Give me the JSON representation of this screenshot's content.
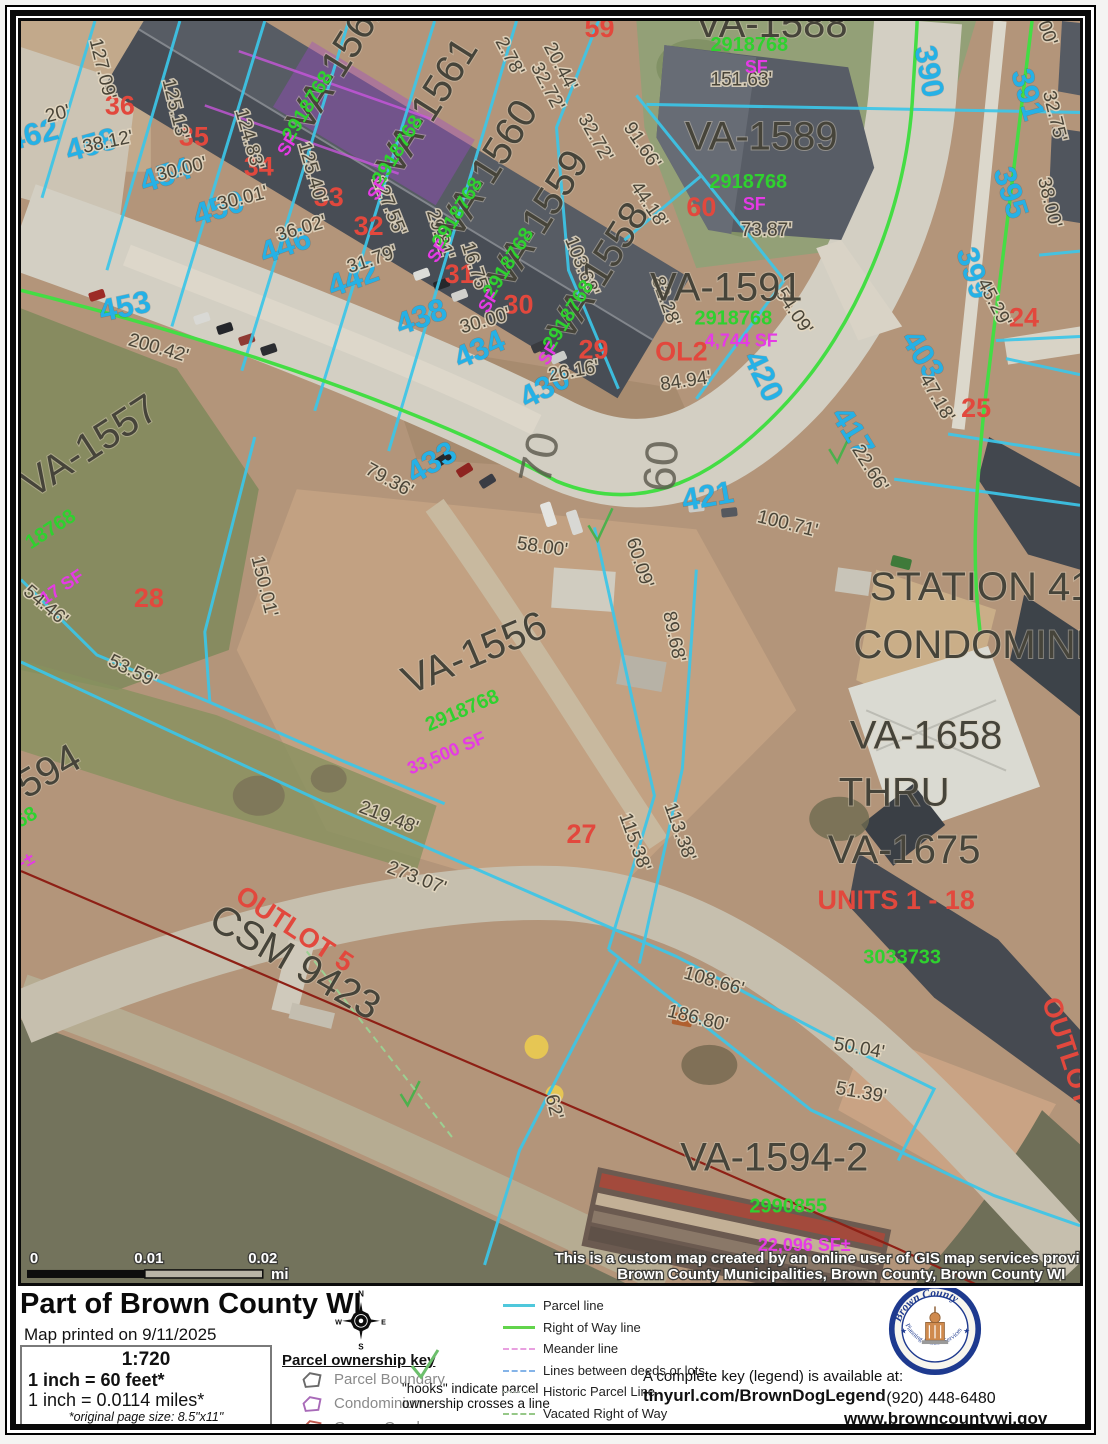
{
  "map": {
    "labels": [
      {
        "t": "462",
        "x": 38,
        "y": 137,
        "r": -14,
        "c": "addr"
      },
      {
        "t": "458",
        "x": 97,
        "y": 147,
        "r": -16,
        "c": "addr"
      },
      {
        "t": "454",
        "x": 172,
        "y": 177,
        "r": -18,
        "c": "addr"
      },
      {
        "t": "450",
        "x": 225,
        "y": 210,
        "r": -18,
        "c": "addr"
      },
      {
        "t": "446",
        "x": 292,
        "y": 247,
        "r": -20,
        "c": "addr"
      },
      {
        "t": "442",
        "x": 360,
        "y": 280,
        "r": -20,
        "c": "addr"
      },
      {
        "t": "438",
        "x": 428,
        "y": 318,
        "r": -20,
        "c": "addr"
      },
      {
        "t": "434",
        "x": 487,
        "y": 350,
        "r": -24,
        "c": "addr"
      },
      {
        "t": "430",
        "x": 553,
        "y": 388,
        "r": -28,
        "c": "addr"
      },
      {
        "t": "453",
        "x": 130,
        "y": 308,
        "r": -12,
        "c": "addr"
      },
      {
        "t": "433",
        "x": 440,
        "y": 462,
        "r": -30,
        "c": "addr"
      },
      {
        "t": "421",
        "x": 713,
        "y": 497,
        "r": -10,
        "c": "addr"
      },
      {
        "t": "420",
        "x": 758,
        "y": 372,
        "r": 64,
        "c": "addr"
      },
      {
        "t": "417",
        "x": 848,
        "y": 428,
        "r": 58,
        "c": "addr"
      },
      {
        "t": "403",
        "x": 918,
        "y": 352,
        "r": 58,
        "c": "addr"
      },
      {
        "t": "399",
        "x": 968,
        "y": 268,
        "r": 72,
        "c": "addr"
      },
      {
        "t": "395",
        "x": 1005,
        "y": 188,
        "r": 72,
        "c": "addr"
      },
      {
        "t": "391",
        "x": 1022,
        "y": 90,
        "r": 74,
        "c": "addr"
      },
      {
        "t": "390",
        "x": 923,
        "y": 66,
        "r": 80,
        "c": "addr"
      },
      {
        "t": "36",
        "x": 123,
        "y": 107,
        "r": 0,
        "c": "lot"
      },
      {
        "t": "35",
        "x": 197,
        "y": 138,
        "r": 0,
        "c": "lot"
      },
      {
        "t": "34",
        "x": 262,
        "y": 168,
        "r": 0,
        "c": "lot"
      },
      {
        "t": "33",
        "x": 332,
        "y": 198,
        "r": 0,
        "c": "lot"
      },
      {
        "t": "32",
        "x": 372,
        "y": 227,
        "r": 0,
        "c": "lot"
      },
      {
        "t": "31",
        "x": 463,
        "y": 275,
        "r": 0,
        "c": "lot"
      },
      {
        "t": "30",
        "x": 522,
        "y": 305,
        "r": 0,
        "c": "lot"
      },
      {
        "t": "29",
        "x": 597,
        "y": 350,
        "r": 0,
        "c": "lot"
      },
      {
        "t": "28",
        "x": 152,
        "y": 597,
        "r": 0,
        "c": "lot",
        "s": 30
      },
      {
        "t": "27",
        "x": 585,
        "y": 832,
        "r": 0,
        "c": "lot",
        "s": 30
      },
      {
        "t": "59",
        "x": 603,
        "y": 30,
        "r": 0,
        "c": "lot"
      },
      {
        "t": "60",
        "x": 705,
        "y": 208,
        "r": 0,
        "c": "lot"
      },
      {
        "t": "24",
        "x": 1028,
        "y": 318,
        "r": 0,
        "c": "lot",
        "s": 30
      },
      {
        "t": "25",
        "x": 980,
        "y": 408,
        "r": 0,
        "c": "lot",
        "s": 30
      },
      {
        "t": "23",
        "x": 1098,
        "y": 222,
        "r": 0,
        "c": "lot"
      },
      {
        "t": "OL2",
        "x": 685,
        "y": 352,
        "r": 0,
        "c": "lot",
        "s": 30
      },
      {
        "t": "UNITS 1 - 18",
        "x": 900,
        "y": 898,
        "r": 0,
        "c": "lot",
        "s": 28
      },
      {
        "t": "OUTLOT 5",
        "x": 293,
        "y": 925,
        "r": 33,
        "c": "lot",
        "s": 32
      },
      {
        "t": "OUTLOT",
        "x": 1063,
        "y": 1042,
        "r": 72,
        "c": "lot",
        "s": 26
      },
      {
        "t": "20'",
        "x": 62,
        "y": 112,
        "r": -14,
        "c": "dim"
      },
      {
        "t": "127.09'",
        "x": 100,
        "y": 63,
        "r": 76,
        "c": "dim"
      },
      {
        "t": "38.12'",
        "x": 112,
        "y": 140,
        "r": -12,
        "c": "dim"
      },
      {
        "t": "125.13'",
        "x": 173,
        "y": 103,
        "r": 76,
        "c": "dim"
      },
      {
        "t": "30.00'",
        "x": 186,
        "y": 167,
        "r": -14,
        "c": "dim"
      },
      {
        "t": "124.83'",
        "x": 247,
        "y": 133,
        "r": 74,
        "c": "dim"
      },
      {
        "t": "30.01'",
        "x": 247,
        "y": 196,
        "r": -14,
        "c": "dim"
      },
      {
        "t": "125.40'",
        "x": 310,
        "y": 166,
        "r": 74,
        "c": "dim"
      },
      {
        "t": "36.02'",
        "x": 306,
        "y": 226,
        "r": -16,
        "c": "dim"
      },
      {
        "t": "127.55'",
        "x": 387,
        "y": 200,
        "r": 68,
        "c": "dim"
      },
      {
        "t": "31.79'",
        "x": 377,
        "y": 257,
        "r": -18,
        "c": "dim"
      },
      {
        "t": "29.81'",
        "x": 438,
        "y": 228,
        "r": 72,
        "c": "dim"
      },
      {
        "t": "16.75'",
        "x": 473,
        "y": 261,
        "r": 72,
        "c": "dim"
      },
      {
        "t": "30.00'",
        "x": 490,
        "y": 318,
        "r": -16,
        "c": "dim"
      },
      {
        "t": "103.68'",
        "x": 580,
        "y": 260,
        "r": 68,
        "c": "dim"
      },
      {
        "t": "26.16'",
        "x": 578,
        "y": 368,
        "r": -10,
        "c": "dim"
      },
      {
        "t": "2.78'",
        "x": 508,
        "y": 52,
        "r": 62,
        "c": "dim"
      },
      {
        "t": "20.44'",
        "x": 559,
        "y": 62,
        "r": 62,
        "c": "dim"
      },
      {
        "t": "32.72'",
        "x": 546,
        "y": 82,
        "r": 62,
        "c": "dim"
      },
      {
        "t": "32.72'",
        "x": 594,
        "y": 133,
        "r": 60,
        "c": "dim"
      },
      {
        "t": "91.66'",
        "x": 641,
        "y": 141,
        "r": 56,
        "c": "dim"
      },
      {
        "t": "44.18'",
        "x": 648,
        "y": 200,
        "r": 56,
        "c": "dim"
      },
      {
        "t": "151.63'",
        "x": 745,
        "y": 78,
        "r": 0,
        "c": "dim"
      },
      {
        "t": "73.87'",
        "x": 770,
        "y": 228,
        "r": 0,
        "c": "dim"
      },
      {
        "t": "82.28'",
        "x": 664,
        "y": 295,
        "r": 70,
        "c": "dim"
      },
      {
        "t": "84.94'",
        "x": 690,
        "y": 378,
        "r": -8,
        "c": "dim"
      },
      {
        "t": "54.09'",
        "x": 793,
        "y": 306,
        "r": 56,
        "c": "dim"
      },
      {
        "t": "22.66'",
        "x": 869,
        "y": 462,
        "r": 58,
        "c": "dim"
      },
      {
        "t": "100.71'",
        "x": 790,
        "y": 520,
        "r": 14,
        "c": "dim"
      },
      {
        "t": "47.18'",
        "x": 936,
        "y": 392,
        "r": 60,
        "c": "dim"
      },
      {
        "t": "45.29'",
        "x": 993,
        "y": 297,
        "r": 62,
        "c": "dim"
      },
      {
        "t": "38.00'",
        "x": 1048,
        "y": 196,
        "r": 76,
        "c": "dim"
      },
      {
        "t": "32.75'",
        "x": 1053,
        "y": 110,
        "r": 76,
        "c": "dim"
      },
      {
        "t": "00'",
        "x": 1046,
        "y": 28,
        "r": 70,
        "c": "dim"
      },
      {
        "t": "200.42'",
        "x": 160,
        "y": 345,
        "r": 16,
        "c": "dim"
      },
      {
        "t": "79.36'",
        "x": 390,
        "y": 476,
        "r": 28,
        "c": "dim"
      },
      {
        "t": "58.00'",
        "x": 545,
        "y": 543,
        "r": 8,
        "c": "dim"
      },
      {
        "t": "60.09'",
        "x": 638,
        "y": 555,
        "r": 72,
        "c": "dim"
      },
      {
        "t": "89.68'",
        "x": 672,
        "y": 628,
        "r": 78,
        "c": "dim"
      },
      {
        "t": "150.01'",
        "x": 262,
        "y": 578,
        "r": 76,
        "c": "dim"
      },
      {
        "t": "54.46'",
        "x": 45,
        "y": 600,
        "r": 40,
        "c": "dim"
      },
      {
        "t": "53.59'",
        "x": 133,
        "y": 666,
        "r": 26,
        "c": "dim"
      },
      {
        "t": "219.48'",
        "x": 390,
        "y": 812,
        "r": 21,
        "c": "dim"
      },
      {
        "t": "273.07'",
        "x": 418,
        "y": 872,
        "r": 21,
        "c": "dim"
      },
      {
        "t": "115.38'",
        "x": 633,
        "y": 833,
        "r": 70,
        "c": "dim"
      },
      {
        "t": "113.38'",
        "x": 678,
        "y": 823,
        "r": 70,
        "c": "dim"
      },
      {
        "t": "108.66'",
        "x": 716,
        "y": 975,
        "r": 16,
        "c": "dim"
      },
      {
        "t": "186.80'",
        "x": 700,
        "y": 1012,
        "r": 14,
        "c": "dim"
      },
      {
        "t": "50.04'",
        "x": 862,
        "y": 1042,
        "r": 10,
        "c": "dim"
      },
      {
        "t": "51.39'",
        "x": 864,
        "y": 1086,
        "r": 10,
        "c": "dim"
      },
      {
        "t": "62'",
        "x": 552,
        "y": 1096,
        "r": 76,
        "c": "dim"
      },
      {
        "t": "VA-1562",
        "x": 352,
        "y": 62,
        "r": -58,
        "c": "parcel",
        "s": 40
      },
      {
        "t": "VA-1561",
        "x": 442,
        "y": 106,
        "r": -58,
        "c": "parcel",
        "s": 40
      },
      {
        "t": "VA-1560",
        "x": 502,
        "y": 168,
        "r": -58,
        "c": "parcel",
        "s": 40
      },
      {
        "t": "VA-1559",
        "x": 553,
        "y": 218,
        "r": -58,
        "c": "parcel",
        "s": 40
      },
      {
        "t": "VA-1558",
        "x": 613,
        "y": 270,
        "r": -58,
        "c": "parcel",
        "s": 40
      },
      {
        "t": "VA-1588",
        "x": 775,
        "y": 30,
        "r": 0,
        "c": "parcel",
        "s": 38
      },
      {
        "t": "VA-1589",
        "x": 765,
        "y": 142,
        "r": 0,
        "c": "parcel",
        "s": 40
      },
      {
        "t": "VA-1591",
        "x": 730,
        "y": 292,
        "r": 0,
        "c": "parcel",
        "s": 24
      },
      {
        "t": "VA-1557",
        "x": 100,
        "y": 448,
        "r": -33,
        "c": "parcel",
        "s": 46
      },
      {
        "t": "VA-1556",
        "x": 483,
        "y": 655,
        "r": -23,
        "c": "parcel",
        "s": 54
      },
      {
        "t": "594",
        "x": 58,
        "y": 772,
        "r": -30,
        "c": "parcel",
        "s": 42
      },
      {
        "t": "VA-1594-2",
        "x": 778,
        "y": 1158,
        "r": 0,
        "c": "parcel",
        "s": 46
      },
      {
        "t": "STATION 41",
        "x": 985,
        "y": 590,
        "r": 0,
        "c": "parcel",
        "s": 40
      },
      {
        "t": "CONDOMINIUM",
        "x": 1005,
        "y": 648,
        "r": 0,
        "c": "parcel",
        "s": 40
      },
      {
        "t": "VA-1658",
        "x": 930,
        "y": 738,
        "r": 0,
        "c": "parcel",
        "s": 44
      },
      {
        "t": "THRU",
        "x": 898,
        "y": 795,
        "r": 0,
        "c": "parcel",
        "s": 44
      },
      {
        "t": "VA-1675",
        "x": 908,
        "y": 852,
        "r": 0,
        "c": "parcel",
        "s": 44
      },
      {
        "t": "CSM 9423",
        "x": 292,
        "y": 962,
        "r": 30,
        "c": "parcel",
        "s": 34
      },
      {
        "t": "CSM",
        "x": 1096,
        "y": 1098,
        "r": 70,
        "c": "parcel",
        "s": 26
      },
      {
        "t": "70",
        "x": 558,
        "y": 452,
        "r": -78,
        "c": "road"
      },
      {
        "t": "60",
        "x": 680,
        "y": 458,
        "r": -86,
        "c": "road"
      },
      {
        "t": "2918768",
        "x": 316,
        "y": 102,
        "r": -58,
        "c": "doc",
        "s": 19
      },
      {
        "t": "2918768",
        "x": 406,
        "y": 146,
        "r": -58,
        "c": "doc",
        "s": 19
      },
      {
        "t": "2918768",
        "x": 466,
        "y": 208,
        "r": -58,
        "c": "doc",
        "s": 19
      },
      {
        "t": "2918768",
        "x": 517,
        "y": 258,
        "r": -58,
        "c": "doc",
        "s": 19
      },
      {
        "t": "2918768",
        "x": 577,
        "y": 310,
        "r": -58,
        "c": "doc",
        "s": 19
      },
      {
        "t": "2918768",
        "x": 753,
        "y": 44,
        "r": 0,
        "c": "doc",
        "s": 20
      },
      {
        "t": "2918768",
        "x": 752,
        "y": 180,
        "r": 0,
        "c": "doc",
        "s": 20
      },
      {
        "t": "2918768",
        "x": 737,
        "y": 316,
        "r": 0,
        "c": "doc",
        "s": 16
      },
      {
        "t": "18768",
        "x": 57,
        "y": 525,
        "r": -33,
        "c": "doc",
        "s": 26
      },
      {
        "t": "2918768",
        "x": 468,
        "y": 706,
        "r": -23,
        "c": "doc",
        "s": 30
      },
      {
        "t": "68",
        "x": 32,
        "y": 812,
        "r": -30,
        "c": "doc",
        "s": 26
      },
      {
        "t": "2990855",
        "x": 792,
        "y": 1200,
        "r": 0,
        "c": "doc",
        "s": 30
      },
      {
        "t": "3033733",
        "x": 906,
        "y": 952,
        "r": 0,
        "c": "doc",
        "s": 26
      },
      {
        "t": "SF",
        "x": 296,
        "y": 140,
        "r": -58,
        "c": "sf",
        "s": 15
      },
      {
        "t": "SF",
        "x": 386,
        "y": 184,
        "r": -58,
        "c": "sf",
        "s": 15
      },
      {
        "t": "SF",
        "x": 446,
        "y": 246,
        "r": -58,
        "c": "sf",
        "s": 15
      },
      {
        "t": "SF",
        "x": 497,
        "y": 296,
        "r": -58,
        "c": "sf",
        "s": 15
      },
      {
        "t": "SF",
        "x": 557,
        "y": 348,
        "r": -58,
        "c": "sf",
        "s": 15
      },
      {
        "t": "SF",
        "x": 760,
        "y": 66,
        "r": 0,
        "c": "sf",
        "s": 17
      },
      {
        "t": "SF",
        "x": 758,
        "y": 202,
        "r": 0,
        "c": "sf",
        "s": 17
      },
      {
        "t": "4,744 SF",
        "x": 745,
        "y": 338,
        "r": 0,
        "c": "sf",
        "s": 16
      },
      {
        "t": "17 SF",
        "x": 68,
        "y": 582,
        "r": -33,
        "c": "sf",
        "s": 30
      },
      {
        "t": "33,500 SF",
        "x": 452,
        "y": 748,
        "r": -23,
        "c": "sf",
        "s": 32
      },
      {
        "t": "F±",
        "x": 30,
        "y": 856,
        "r": -30,
        "c": "sf",
        "s": 28
      },
      {
        "t": "22,096 SF±",
        "x": 808,
        "y": 1238,
        "r": 0,
        "c": "sf",
        "s": 32
      },
      {
        "t": "0",
        "x": 37,
        "y": 1250,
        "r": 0,
        "c": "white",
        "s": 15
      },
      {
        "t": "0.01",
        "x": 152,
        "y": 1250,
        "r": 0,
        "c": "white",
        "s": 15
      },
      {
        "t": "0.02",
        "x": 266,
        "y": 1250,
        "r": 0,
        "c": "white",
        "s": 15
      },
      {
        "t": "mi",
        "x": 283,
        "y": 1266,
        "r": 0,
        "c": "white",
        "s": 14
      },
      {
        "t": "This is a custom map created by an online user of GIS map services provided by",
        "x": 845,
        "y": 1250,
        "r": 0,
        "c": "white",
        "s": 14.5
      },
      {
        "t": "Brown County Municipalities, Brown County, Brown County WI",
        "x": 845,
        "y": 1266,
        "r": 0,
        "c": "white",
        "s": 14.5
      }
    ]
  },
  "footer": {
    "title": "Part of Brown County WI",
    "printed": "Map printed on 9/11/2025",
    "scale_box": {
      "ratio": "1:720",
      "feet": "1 inch = 60 feet*",
      "miles": "1 inch = 0.0114 miles*",
      "note1": "*original page size: 8.5\"x11\"",
      "note2": "Appropriate format depends on zoom level"
    },
    "compass": {
      "n": "N",
      "e": "E",
      "s": "S",
      "w": "W"
    },
    "ownership_key": {
      "title": "Parcel ownership key",
      "items": [
        {
          "label": "Parcel Boundary",
          "color": "#6a6a6a"
        },
        {
          "label": "Condominium",
          "color": "#a86ab8"
        },
        {
          "label": "Gap or Overlap",
          "color": "#c05a50"
        }
      ],
      "hooks_note": "\"hooks\" indicate parcel ownership crosses a line"
    },
    "legend": {
      "items": [
        {
          "label": "Parcel line",
          "style": "solid",
          "color": "#4fc8dc"
        },
        {
          "label": "Right of Way line",
          "style": "solid",
          "color": "#62d44c"
        },
        {
          "label": "Meander line",
          "style": "dashed",
          "color": "#e8a0e0"
        },
        {
          "label": "Lines between deeds or lots",
          "style": "dashed",
          "color": "#85b4e8"
        },
        {
          "label": "Historic Parcel Line",
          "style": "dotted",
          "color": "#a8b0a8"
        },
        {
          "label": "Vacated Right of Way",
          "style": "dashdot",
          "color": "#96c888"
        }
      ]
    },
    "complete_key": {
      "line1": "A complete key (legend) is available at:",
      "line2": "tinyurl.com/BrownDogLegend"
    },
    "contact": {
      "phone": "(920) 448-6480",
      "web": "www.browncountywi.gov"
    },
    "logo": {
      "org": "Brown County",
      "dept": "Planning & Land Services"
    }
  }
}
